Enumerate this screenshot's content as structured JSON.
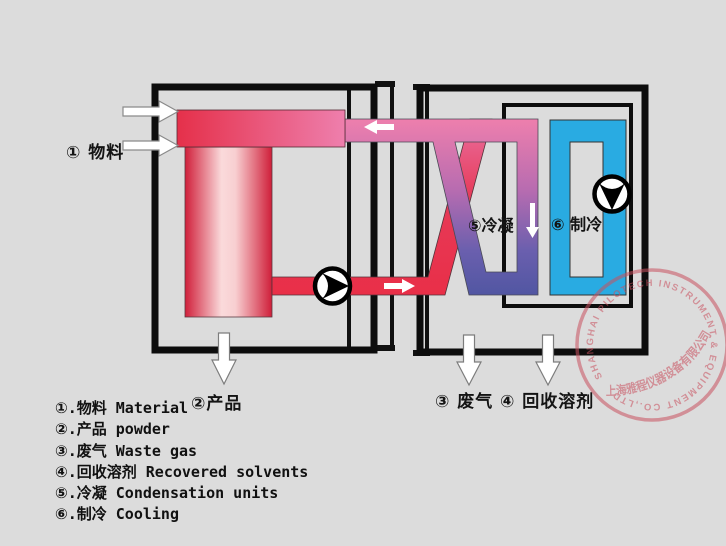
{
  "diagram": {
    "labels": {
      "material": "① 物料",
      "product": "②产品",
      "waste_gas": "③ 废气",
      "recovered_solvents": "④ 回收溶剂",
      "condensation": "⑤冷凝",
      "cooling": "⑥ 制冷"
    },
    "colors": {
      "background": "#dcdcdc",
      "border": "#0d0d0d",
      "hot_red": "#e92f48",
      "pink": "#ee7fad",
      "purple": "#5156a2",
      "cooling_blue": "#29abe2",
      "stamp_red": "#c9515f"
    }
  },
  "legend": {
    "items": [
      "①.物料 Material",
      "②.产品 powder",
      "③.废气 Waste gas",
      "④.回收溶剂 Recovered solvents",
      "⑤.冷凝 Condensation units",
      "⑥.制冷 Cooling"
    ]
  },
  "stamp": {
    "ring_text": "SHANGHAI PILOTECH INSTRUMENT & EQUIPMENT CO.,LTD",
    "center_text": "上海雅程仪器设备有限公司"
  }
}
